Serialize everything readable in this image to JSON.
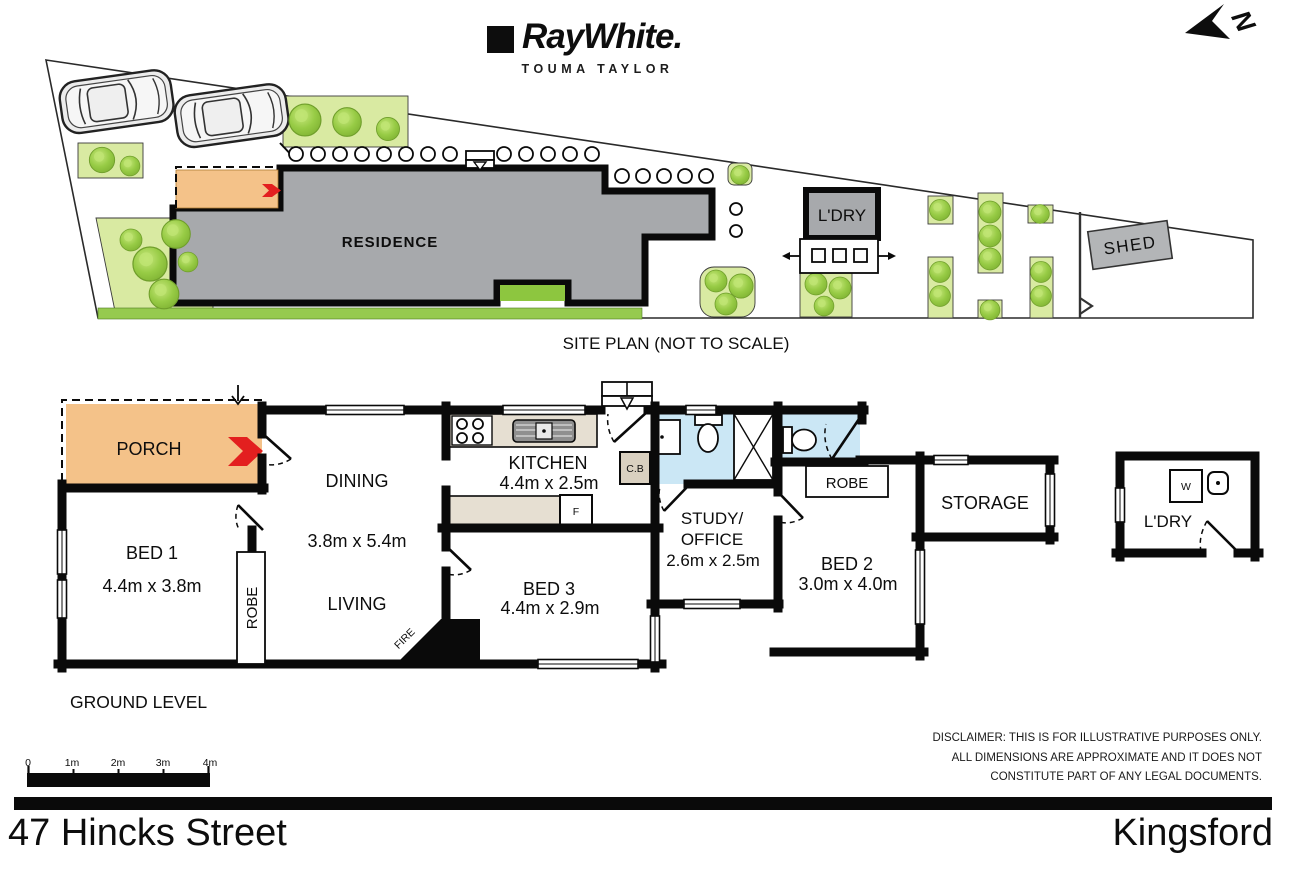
{
  "logo": {
    "brand": "RayWhite.",
    "agency": "TOUMA TAYLOR"
  },
  "compass": {
    "label": "N"
  },
  "site_plan": {
    "caption": "SITE PLAN (NOT TO SCALE)",
    "labels": {
      "residence": "RESIDENCE",
      "laundry": "L'DRY",
      "shed": "SHED"
    }
  },
  "floor_plan": {
    "level_label": "GROUND LEVEL",
    "rooms": [
      {
        "name": "PORCH"
      },
      {
        "name": "BED 1",
        "dims": "4.4m x 3.8m"
      },
      {
        "name": "DINING",
        "dims": "3.8m x 5.4m"
      },
      {
        "name": "LIVING"
      },
      {
        "name": "ROBE"
      },
      {
        "name": "KITCHEN",
        "dims": "4.4m x 2.5m"
      },
      {
        "name": "BED 3",
        "dims": "4.4m x 2.9m"
      },
      {
        "name": "STUDY/",
        "name_line2": "OFFICE",
        "dims": "2.6m x 2.5m"
      },
      {
        "name": "BED 2",
        "dims": "3.0m x 4.0m"
      },
      {
        "name": "ROBE"
      },
      {
        "name": "STORAGE"
      },
      {
        "name": "L'DRY"
      }
    ],
    "annotations": {
      "fireplace": "FIRE",
      "cupboard": "C.B",
      "fridge": "F",
      "washer": "W"
    }
  },
  "scale_bar": {
    "labels": [
      "0",
      "1m",
      "2m",
      "3m",
      "4m"
    ]
  },
  "disclaimer": {
    "lines": [
      "DISCLAIMER: THIS IS FOR ILLUSTRATIVE PURPOSES ONLY.",
      "ALL DIMENSIONS ARE APPROXIMATE AND IT DOES NOT",
      "CONSTITUTE PART OF ANY LEGAL DOCUMENTS."
    ]
  },
  "footer": {
    "street": "47 Hincks Street",
    "suburb": "Kingsford"
  },
  "colors": {
    "porch": "#f4c289",
    "residence": "#a7a9ac",
    "wet_area": "#cbe7f5",
    "garden": "#d9eaa2",
    "tree": "#8dc63f",
    "arrow_red": "#e31f1f"
  }
}
